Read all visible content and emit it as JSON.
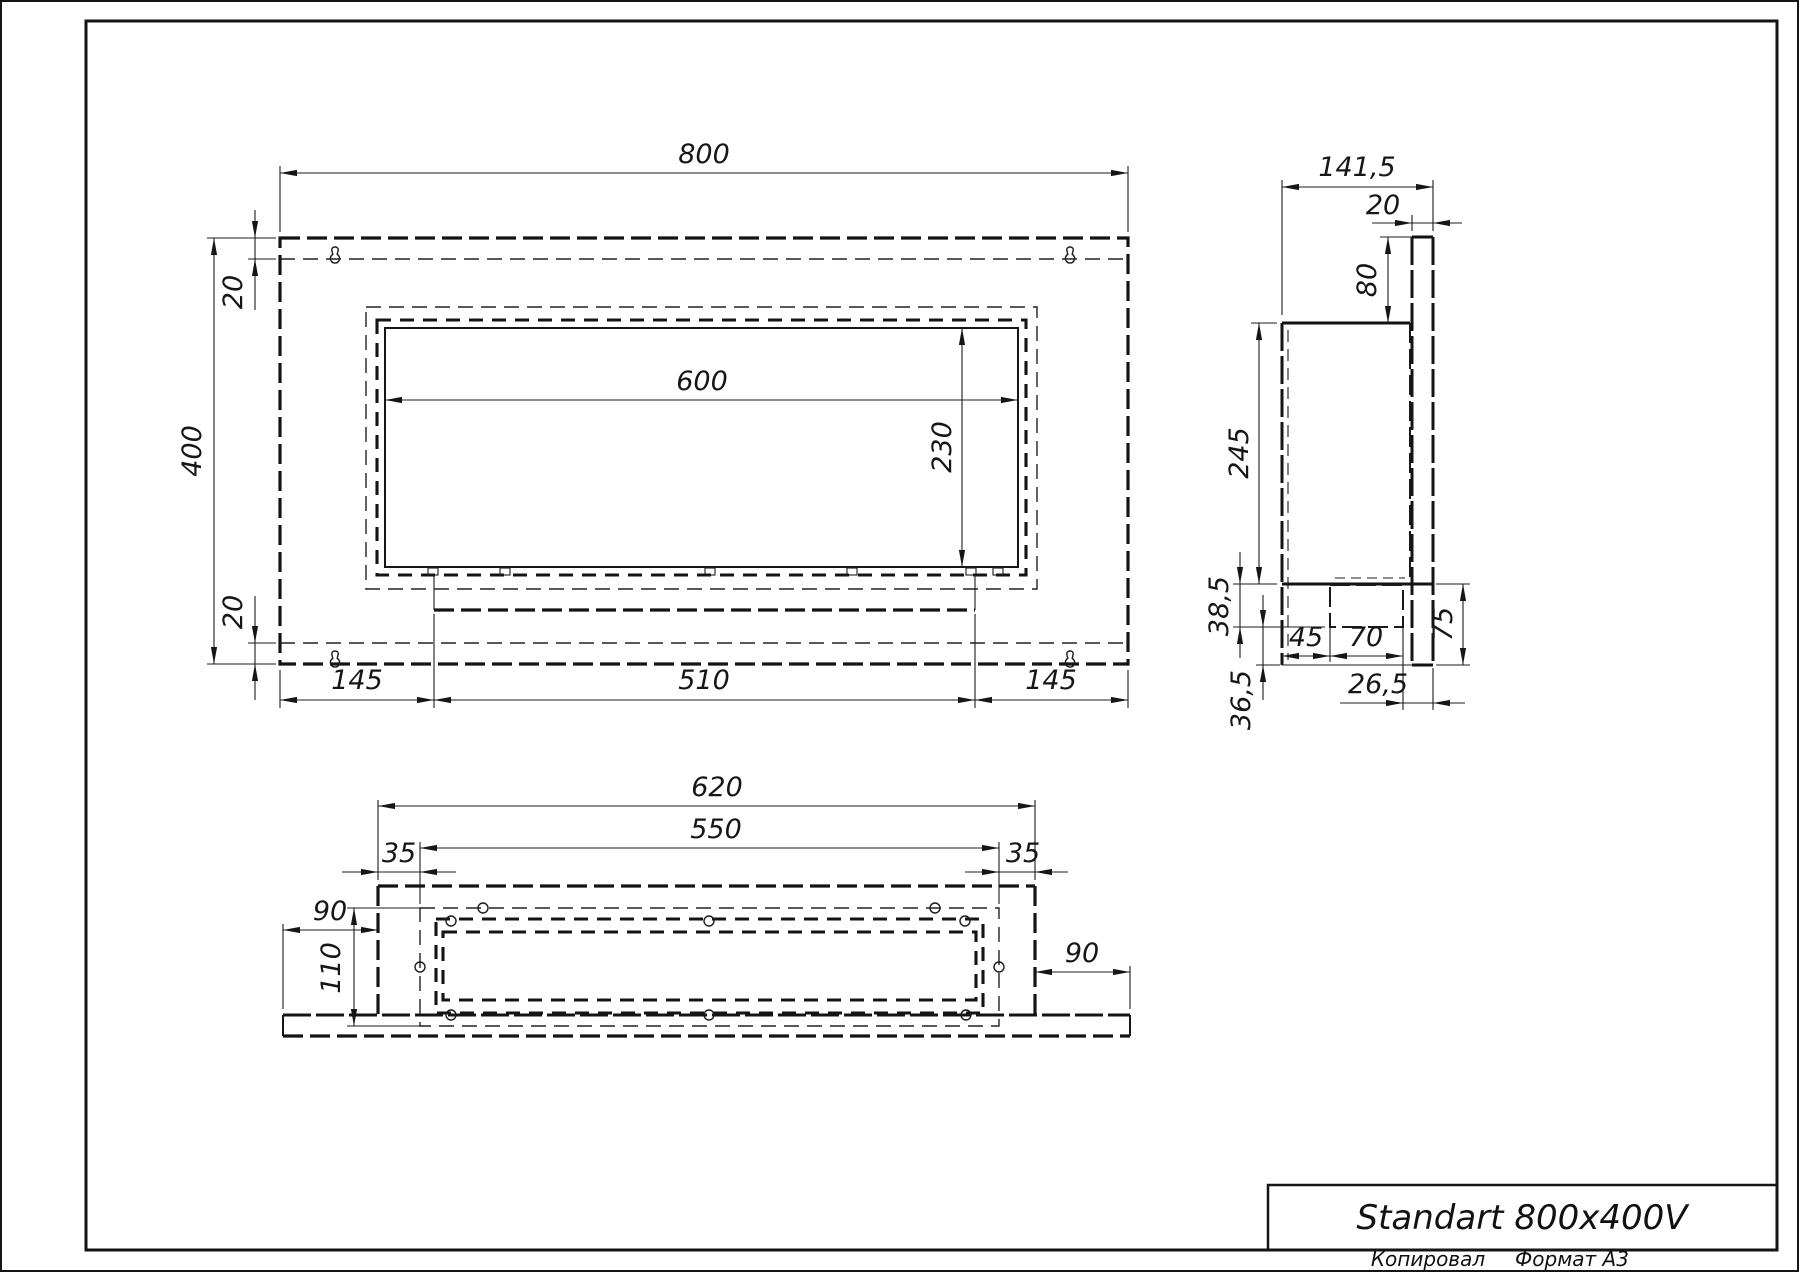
{
  "titleblock": {
    "title": "Standart 800x400V",
    "copied_label": "Копировал",
    "format_label": "Формат A3"
  },
  "front_view": {
    "dims": {
      "width": "800",
      "height": "400",
      "top_offset": "20",
      "bottom_offset": "20",
      "opening_width": "600",
      "opening_height": "230",
      "left_margin": "145",
      "tray_width": "510",
      "right_margin": "145"
    }
  },
  "side_view": {
    "dims": {
      "depth": "141,5",
      "bracket_thickness": "20",
      "top_drop": "80",
      "body_height": "245",
      "burner_depth": "38,5",
      "front_gap": "45",
      "tank_width": "70",
      "lower_height": "75",
      "back_offset": "26,5",
      "bottom_drop": "36,5"
    }
  },
  "bottom_view": {
    "dims": {
      "body_width": "620",
      "inner_width": "550",
      "left_inset": "35",
      "right_inset": "35",
      "plate_left_overhang": "90",
      "plate_right_overhang": "90",
      "depth": "110"
    }
  }
}
